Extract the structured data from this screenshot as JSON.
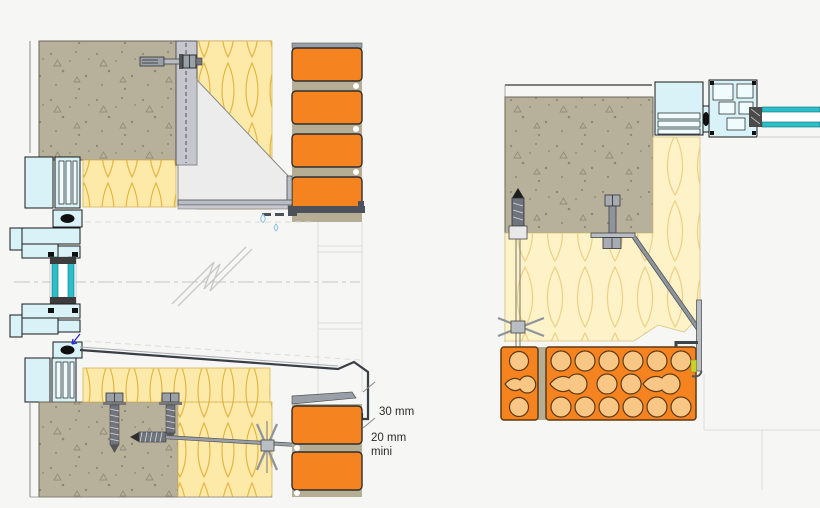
{
  "drawing": {
    "annotations": {
      "drip_height": "30 mm",
      "gap_min_line1": "20 mm",
      "gap_min_line2": "mini"
    },
    "colors": {
      "background": "#f6f6f4",
      "concrete": "#b7b09b",
      "speckle": "#8d8672",
      "insulation": "#fdeaa9",
      "insulation_line": "#e5b647",
      "insulation_soft": "#fdf2c8",
      "insulation_soft_line": "#eed084",
      "brick": "#f5831f",
      "brick_hole": "#f8c786",
      "brick_outline": "#5f3a10",
      "mortar": "#b6ad95",
      "frame": "#d8f2f8",
      "frame_outline": "#1a1a1a",
      "glass": "#2bbfca",
      "steel": "#b9bdc4",
      "steel_dark": "#4d525a",
      "ghost": "#dcdcdc",
      "centerline": "#cfcfcf",
      "dimension_text": "#2b2b2b",
      "arrow_blue": "#2a2ad2",
      "drop_blue": "#8fc3dc"
    }
  }
}
